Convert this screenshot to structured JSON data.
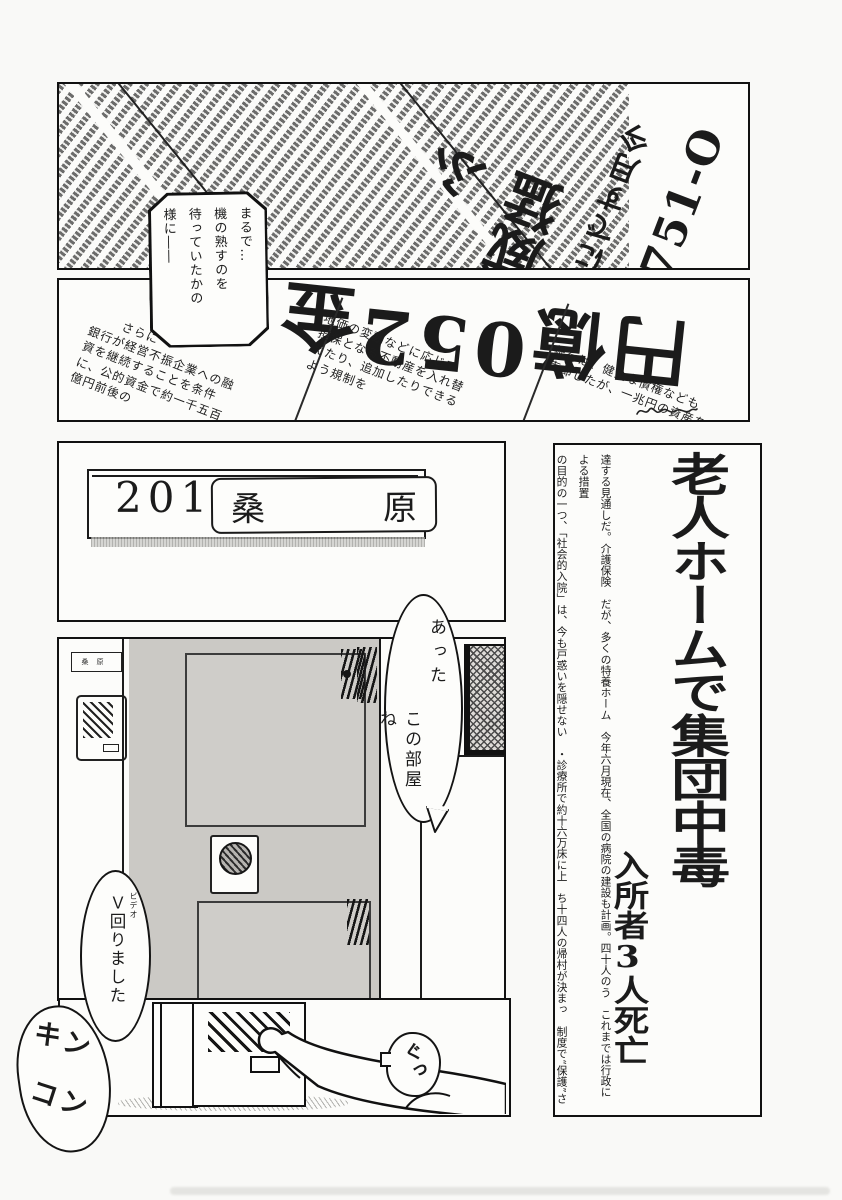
{
  "panel1": {
    "headline_col1": "O-157",
    "headline_col2": "今月すでに4件",
    "headline_col3": "猛威ふ",
    "bubble": {
      "col1": "まるで…",
      "col2": "機の熟すのを",
      "col3": "待っていたかの",
      "col4": "様に――"
    }
  },
  "panel2": {
    "headline": "金250億円",
    "fineprint_a": [
      "さらに",
      "銀行が経営不振企業への融",
      "資を継続することを条件",
      "に、公的資金で約一千五百",
      "億円前後の"
    ],
    "fineprint_b": [
      "地価の変動などに応じて",
      "担保となる不動産を入れ替",
      "えたり、追加したりできる",
      "よう規制を"
    ],
    "fineprint_c": [
      "銀行は、健全な債権なども",
      "売却したが、一兆円の資産を"
    ]
  },
  "panel3": {
    "room_number": "201",
    "name_left": "桑",
    "name_right": "原"
  },
  "article": {
    "headline": "老人ホームで集団中毒",
    "subheadline": "入所者3人死亡",
    "body_col_right": "達する見通しだ。介護保険　だが、多くの特養ホーム　今年六月現在、全国の病院の建設も計画。四十人のう　これまでは行政による措置",
    "body_col_left": "の目的の一つ、「社会的入院」は、今も戸惑いを隠せない　・診療所で約十六万床に上　ち十四人の帰村が決まっ　制度で“保護”されてきた"
  },
  "panel4": {
    "mini_nameplate": "桑原"
  },
  "bubble_found": {
    "col1": "あった",
    "col2": "この部屋ね"
  },
  "bubble_video": {
    "furigana": "ビデオ",
    "text": "Ｖ回りました"
  },
  "bubble_press": {
    "text": "ぐっ"
  },
  "sfx_doorbell": {
    "line1": "キン",
    "line2": "コン"
  }
}
